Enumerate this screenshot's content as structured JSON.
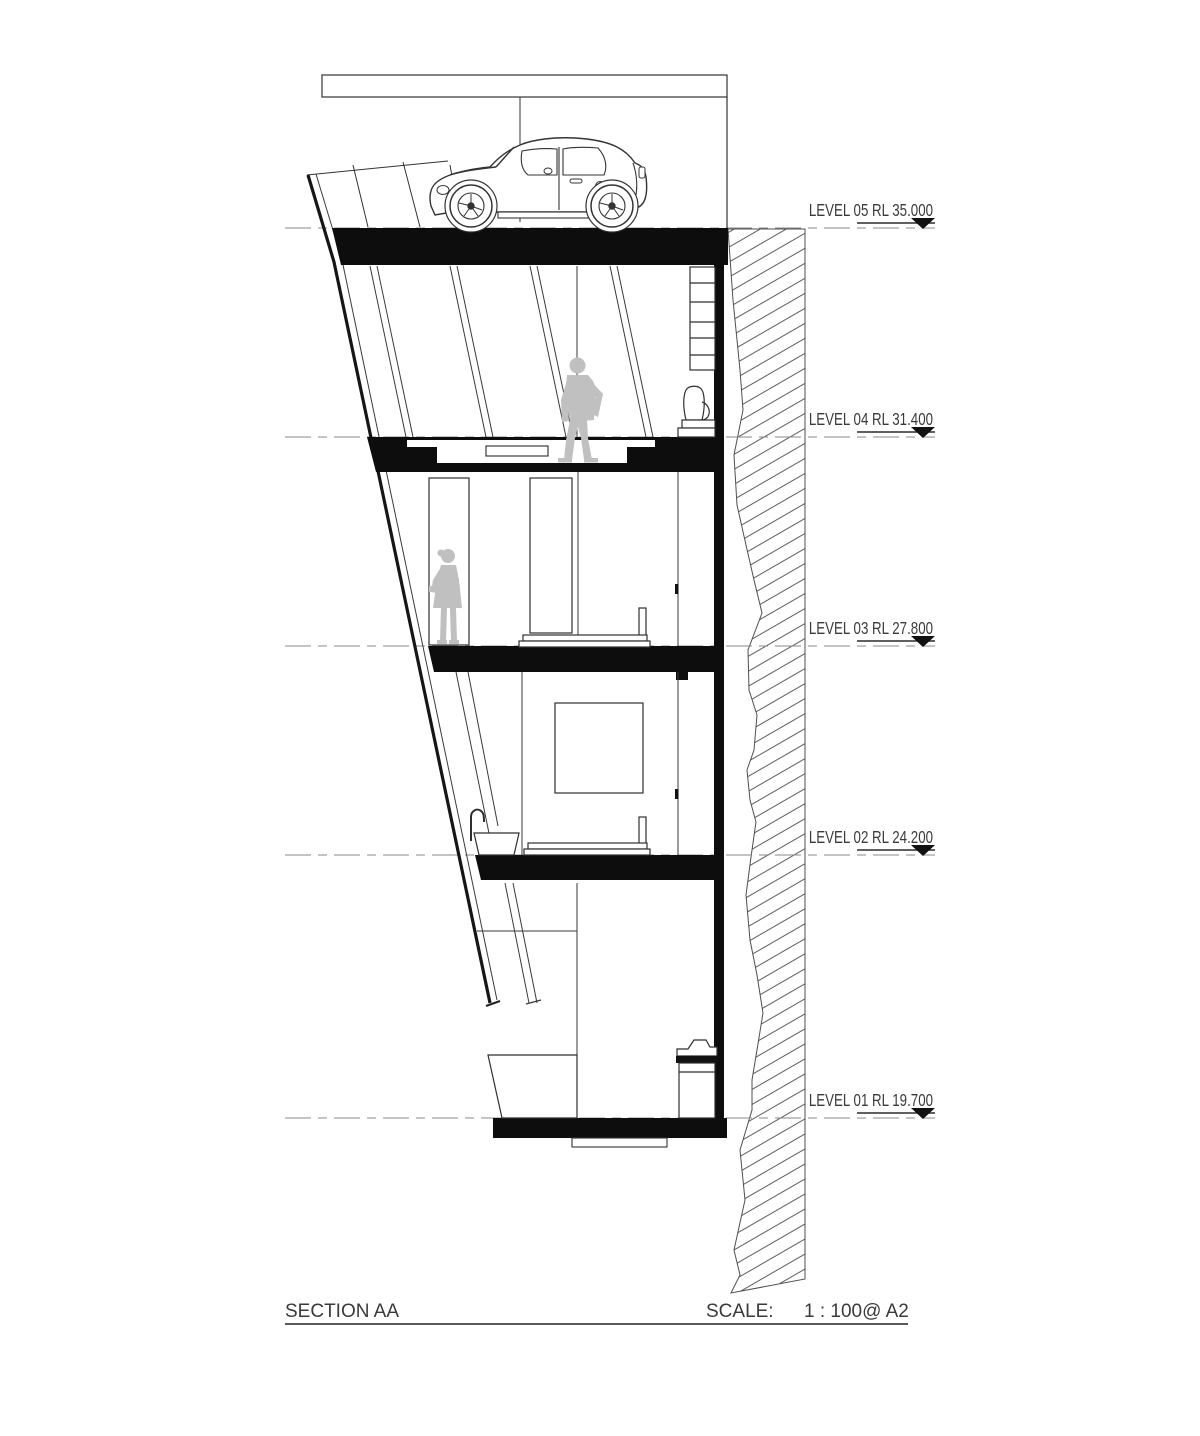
{
  "drawing_type": "architectural-section",
  "title_block": {
    "title": "SECTION AA",
    "scale_label": "SCALE:",
    "scale_value": "1 : 100@ A2"
  },
  "levels": [
    {
      "name": "LEVEL 05",
      "rl": "RL 35.000",
      "label": "LEVEL 05 RL 35.000"
    },
    {
      "name": "LEVEL 04",
      "rl": "RL 31.400",
      "label": "LEVEL 04 RL 31.400"
    },
    {
      "name": "LEVEL 03",
      "rl": "RL 27.800",
      "label": "LEVEL 03 RL 27.800"
    },
    {
      "name": "LEVEL 02",
      "rl": "RL 24.200",
      "label": "LEVEL 02 RL 24.200"
    },
    {
      "name": "LEVEL 01",
      "rl": "RL 19.700",
      "label": "LEVEL 01 RL 19.700"
    }
  ],
  "colors": {
    "line": "#333333",
    "solid_fill": "#0d0d0d",
    "dashed_line": "#8a8a8a",
    "figure_gray": "#c0c0c0",
    "background": "#ffffff"
  },
  "elements": {
    "vehicle": "car-side-view",
    "figures": [
      "standing-man-level-04",
      "standing-woman-level-03"
    ],
    "site": "rock-face-hatch-east"
  }
}
